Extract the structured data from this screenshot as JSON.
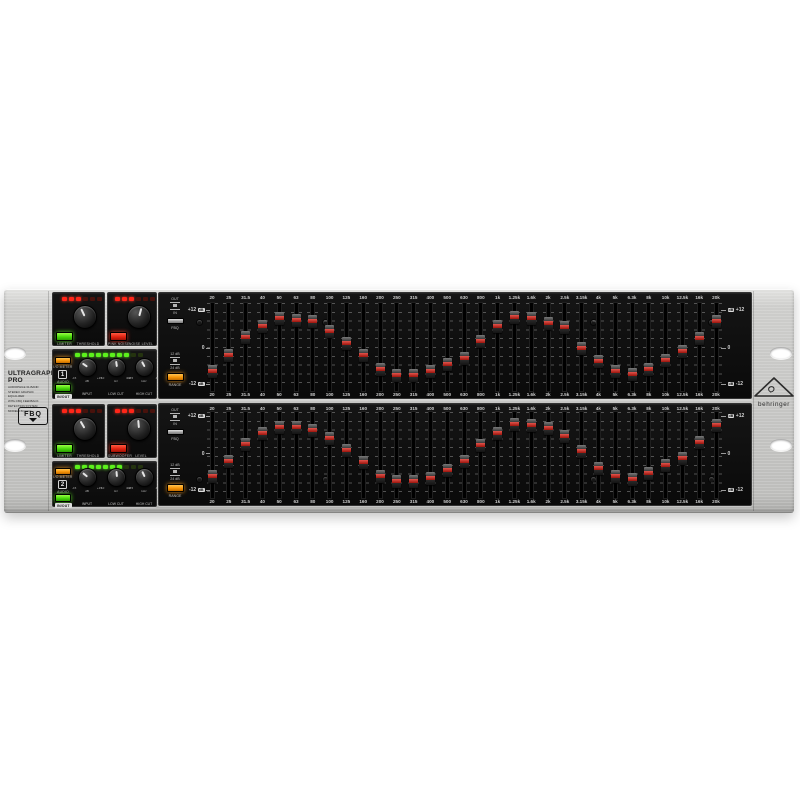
{
  "page": {
    "background": "#ffffff"
  },
  "branding": {
    "title_line1": "ULTRAGRAPH",
    "title_line2": "PRO",
    "desc": [
      "AUDIOPHILE 31-BAND",
      "STEREO GRAPHIC EQUALIZER",
      "WITH FBQ FEEDBACK",
      "DETECTION SYSTEM",
      "MODEL FBQ3102"
    ],
    "fbq_logo": "FBQ",
    "brand_name": "behringer"
  },
  "eq": {
    "frequencies": [
      "20",
      "25",
      "31.5",
      "40",
      "50",
      "63",
      "80",
      "100",
      "125",
      "160",
      "200",
      "250",
      "315",
      "400",
      "500",
      "630",
      "800",
      "1k",
      "1.25k",
      "1.6k",
      "2k",
      "2.5k",
      "3.15k",
      "4k",
      "5k",
      "6.3k",
      "8k",
      "10k",
      "12.5k",
      "16k",
      "20k"
    ],
    "scale": {
      "plus": "+12",
      "zero": "0",
      "minus": "-12",
      "unit": "dB"
    },
    "controls": {
      "out": "OUT",
      "in": "IN",
      "fbq": "FBQ",
      "range_top": "12 dB",
      "range_bottom": "24 dB",
      "range": "RANGE"
    }
  },
  "channels": [
    {
      "number": "1",
      "limiter": {
        "button": "LIMITER",
        "knob": "THRESHOLD",
        "unit": "dB",
        "angle": -25,
        "leds": {
          "total": 6,
          "lit": 3,
          "color": "red"
        }
      },
      "aux": {
        "button": "PINK NOISE",
        "knob": "NOISE LEVEL",
        "unit": "dB",
        "angle": 15,
        "leds": {
          "total": 6,
          "lit": 3,
          "color": "red"
        }
      },
      "io": {
        "meter_label": "I/O METER",
        "audio_label": "AUDIO",
        "inout_label": "IN/OUT",
        "leds": {
          "total": 10,
          "lit": 8,
          "color": "green"
        },
        "knobs": [
          {
            "name": "INPUT",
            "unit": "dB",
            "min": "-15",
            "max": "+15",
            "angle": -55
          },
          {
            "name": "LOW CUT",
            "unit": "Hz",
            "min": "10",
            "max": "400",
            "angle": -8
          },
          {
            "name": "HIGH CUT",
            "unit": "kHz",
            "min": "2.5",
            "max": "40",
            "angle": -28
          }
        ]
      },
      "eq_values": [
        -7.5,
        -2.5,
        3.5,
        7,
        9.5,
        9,
        8.5,
        5.5,
        1.5,
        -2.5,
        -7,
        -9,
        -9,
        -7.5,
        -5.5,
        -3.5,
        2,
        7,
        10,
        9.5,
        8,
        6.5,
        0,
        -4.5,
        -7.5,
        -8.5,
        -7,
        -4,
        -1,
        3,
        8.5
      ]
    },
    {
      "number": "2",
      "limiter": {
        "button": "LIMITER",
        "knob": "THRESHOLD",
        "unit": "dB",
        "angle": -30,
        "leds": {
          "total": 6,
          "lit": 3,
          "color": "red"
        }
      },
      "aux": {
        "button": "SUBWOOFER",
        "knob": "LEVEL",
        "unit": "dB",
        "angle": -5,
        "leds": {
          "total": 6,
          "lit": 3,
          "color": "red"
        }
      },
      "io": {
        "meter_label": "I/O METER",
        "audio_label": "AUDIO",
        "inout_label": "IN/OUT",
        "leds": {
          "total": 10,
          "lit": 7,
          "color": "green"
        },
        "knobs": [
          {
            "name": "INPUT",
            "unit": "dB",
            "min": "-15",
            "max": "+15",
            "angle": -50
          },
          {
            "name": "LOW CUT",
            "unit": "Hz",
            "min": "10",
            "max": "400",
            "angle": -5
          },
          {
            "name": "HIGH CUT",
            "unit": "kHz",
            "min": "2.5",
            "max": "40",
            "angle": -25
          }
        ]
      },
      "eq_values": [
        -7.5,
        -2.5,
        3,
        6.5,
        8.5,
        8.5,
        7.5,
        5,
        1,
        -3,
        -7.5,
        -9,
        -9,
        -8,
        -5.5,
        -2.5,
        2.5,
        6.5,
        9.5,
        9,
        8,
        5.5,
        0.5,
        -5,
        -7.5,
        -8.5,
        -6.5,
        -4,
        -1.5,
        3.5,
        9
      ]
    }
  ]
}
